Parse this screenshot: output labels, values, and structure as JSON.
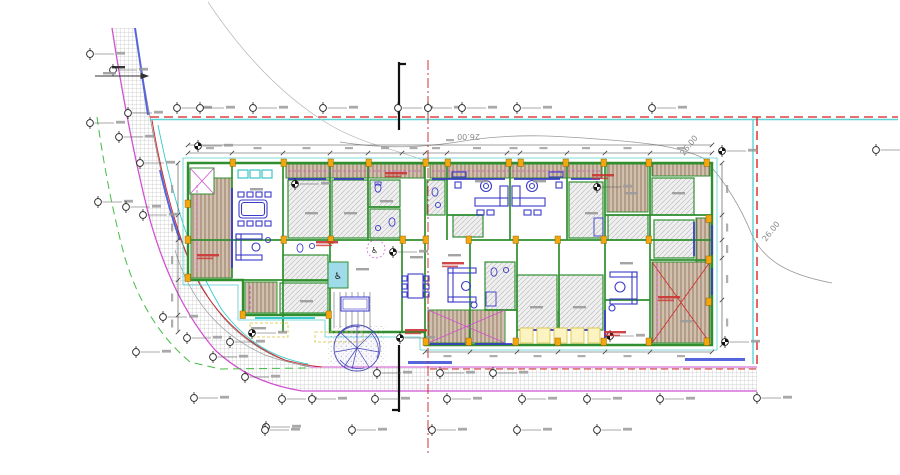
{
  "drawing": {
    "kind": "architectural-site-floor-plan",
    "contour_labels": [
      {
        "text": "26.00",
        "x": 480,
        "y": 134,
        "rot": 180
      },
      {
        "text": "26.00",
        "x": 684,
        "y": 156,
        "rot": -52
      },
      {
        "text": "26.00",
        "x": 766,
        "y": 242,
        "rot": -52
      }
    ],
    "colors": {
      "boundary_red": "#e04040",
      "parcel_cyan": "#5fd3d3",
      "wall_green": "#2f8f2f",
      "furniture_blue": "#3b3bc8",
      "road_magenta": "#d050d0",
      "column_yellow": "#f3a60d",
      "contour_gray": "#999999",
      "setback_green_dashed": "#44bb44",
      "axis_red": "#cc2222"
    },
    "survey_markers": [
      {
        "x": 90,
        "y": 54
      },
      {
        "x": 113,
        "y": 70
      },
      {
        "x": 128,
        "y": 113
      },
      {
        "x": 90,
        "y": 123
      },
      {
        "x": 119,
        "y": 137
      },
      {
        "x": 140,
        "y": 163
      },
      {
        "x": 98,
        "y": 202
      },
      {
        "x": 126,
        "y": 207
      },
      {
        "x": 143,
        "y": 215
      },
      {
        "x": 163,
        "y": 317
      },
      {
        "x": 187,
        "y": 338
      },
      {
        "x": 213,
        "y": 357
      },
      {
        "x": 230,
        "y": 342
      },
      {
        "x": 245,
        "y": 377
      },
      {
        "x": 252,
        "y": 333,
        "f": 1
      },
      {
        "x": 136,
        "y": 352
      },
      {
        "x": 194,
        "y": 398
      },
      {
        "x": 266,
        "y": 427
      },
      {
        "x": 177,
        "y": 108
      },
      {
        "x": 200,
        "y": 108
      },
      {
        "x": 253,
        "y": 108
      },
      {
        "x": 323,
        "y": 108
      },
      {
        "x": 398,
        "y": 108
      },
      {
        "x": 428,
        "y": 108
      },
      {
        "x": 462,
        "y": 108
      },
      {
        "x": 517,
        "y": 108
      },
      {
        "x": 652,
        "y": 108
      },
      {
        "x": 198,
        "y": 146,
        "f": 1
      },
      {
        "x": 295,
        "y": 184,
        "f": 1
      },
      {
        "x": 597,
        "y": 187,
        "f": 1
      },
      {
        "x": 393,
        "y": 252,
        "f": 1
      },
      {
        "x": 400,
        "y": 338,
        "f": 1
      },
      {
        "x": 610,
        "y": 336,
        "f": 1
      },
      {
        "x": 722,
        "y": 151,
        "f": 1
      },
      {
        "x": 725,
        "y": 342,
        "f": 1
      },
      {
        "x": 876,
        "y": 150
      },
      {
        "x": 377,
        "y": 373
      },
      {
        "x": 440,
        "y": 373
      },
      {
        "x": 493,
        "y": 373
      },
      {
        "x": 282,
        "y": 399
      },
      {
        "x": 312,
        "y": 399
      },
      {
        "x": 375,
        "y": 399
      },
      {
        "x": 447,
        "y": 399
      },
      {
        "x": 522,
        "y": 399
      },
      {
        "x": 587,
        "y": 399
      },
      {
        "x": 660,
        "y": 399
      },
      {
        "x": 757,
        "y": 398
      },
      {
        "x": 265,
        "y": 430
      },
      {
        "x": 352,
        "y": 430
      },
      {
        "x": 432,
        "y": 430
      },
      {
        "x": 517,
        "y": 430
      },
      {
        "x": 597,
        "y": 430
      }
    ],
    "illegible_labels": [
      {
        "x": 197,
        "y": 254,
        "c": "red"
      },
      {
        "x": 385,
        "y": 172,
        "c": "red"
      },
      {
        "x": 592,
        "y": 174,
        "c": "red"
      },
      {
        "x": 316,
        "y": 241,
        "c": "red"
      },
      {
        "x": 442,
        "y": 262,
        "c": "red"
      },
      {
        "x": 405,
        "y": 329,
        "c": "red"
      },
      {
        "x": 604,
        "y": 331,
        "c": "red"
      },
      {
        "x": 658,
        "y": 296,
        "c": "red"
      },
      {
        "x": 250,
        "y": 188,
        "c": "gray"
      },
      {
        "x": 305,
        "y": 212,
        "c": "gray"
      },
      {
        "x": 344,
        "y": 212,
        "c": "gray"
      },
      {
        "x": 380,
        "y": 200,
        "c": "gray"
      },
      {
        "x": 475,
        "y": 180,
        "c": "gray"
      },
      {
        "x": 533,
        "y": 180,
        "c": "gray"
      },
      {
        "x": 585,
        "y": 212,
        "c": "gray"
      },
      {
        "x": 625,
        "y": 192,
        "c": "gray"
      },
      {
        "x": 672,
        "y": 192,
        "c": "gray"
      },
      {
        "x": 300,
        "y": 300,
        "c": "gray"
      },
      {
        "x": 448,
        "y": 254,
        "c": "gray"
      },
      {
        "x": 530,
        "y": 306,
        "c": "gray"
      },
      {
        "x": 573,
        "y": 306,
        "c": "gray"
      },
      {
        "x": 620,
        "y": 262,
        "c": "gray"
      },
      {
        "x": 680,
        "y": 320,
        "c": "gray"
      },
      {
        "x": 356,
        "y": 268,
        "c": "gray"
      },
      {
        "x": 410,
        "y": 256,
        "c": "gray"
      },
      {
        "x": 253,
        "y": 327,
        "c": "gray"
      },
      {
        "x": 112,
        "y": 66,
        "c": "dark"
      },
      {
        "x": 103,
        "y": 72,
        "c": "gray"
      }
    ]
  }
}
